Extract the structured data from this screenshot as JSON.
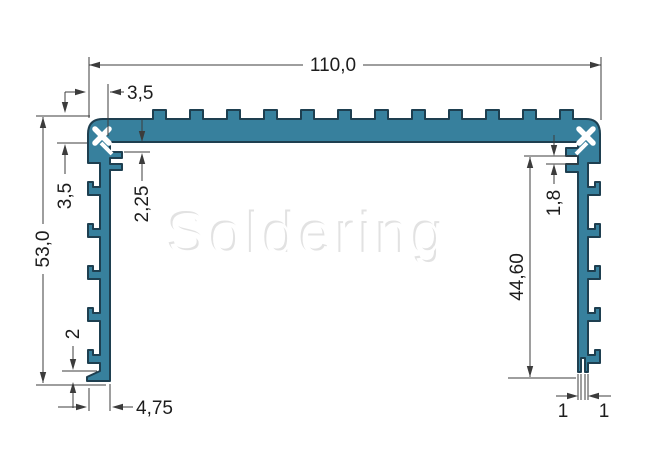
{
  "drawing": {
    "watermark": "Soldering",
    "colors": {
      "profile_fill": "#37809d",
      "profile_outline": "#1e3f50",
      "dimension": "#3c3c3c",
      "watermark_shadow": "#e2e2e2"
    },
    "dimensions": {
      "overall_width": "110,0",
      "top_offset": "3,5",
      "left_flange": "3,5",
      "overall_height": "53,0",
      "left_slot": "2,25",
      "right_slot": "1,8",
      "inner_depth": "44,60",
      "foot_height": "2",
      "wall_width": "4,75",
      "left_leg": "1",
      "right_leg": "1"
    }
  }
}
